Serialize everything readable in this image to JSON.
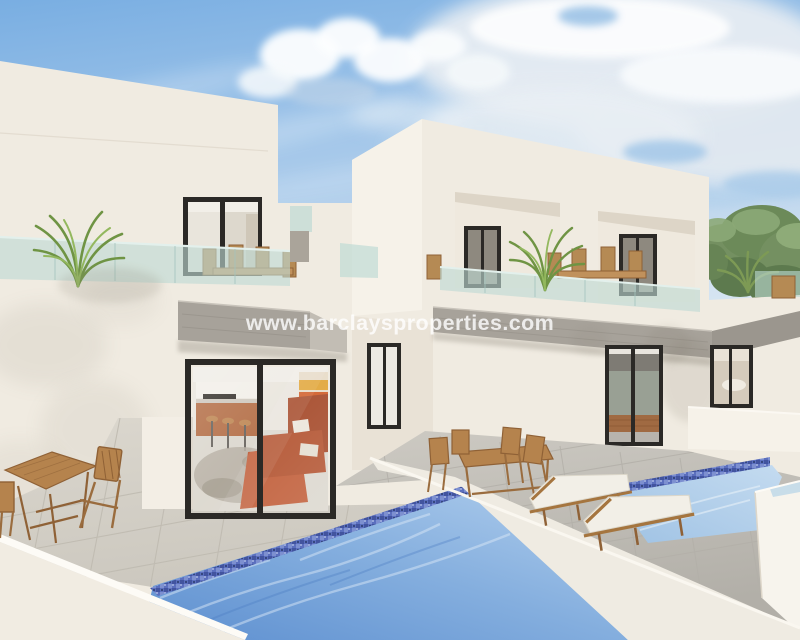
{
  "watermark": {
    "text": "www.barclaysproperties.com"
  },
  "scene": {
    "type": "real-estate-3d-render",
    "subject": "two modern white villas with private pools, roof terraces with glass balustrades, wooden patio furniture and sun loungers"
  },
  "palette": {
    "sky_blue": "#7fb2e2",
    "sky_pale": "#d5e5f2",
    "cloud_white": "#f6f9fc",
    "wall_cream": "#f0ebe1",
    "wall_bright": "#f6f2e9",
    "wall_shadow": "#e4ddd1",
    "concrete_gray": "#a7a29a",
    "glass_teal": "#bedad4",
    "frame_dark": "#2b2926",
    "pool_deep": "#5d8fd0",
    "pool_light": "#b7d4ec",
    "mosaic_blue": "#5b6fbe",
    "waterline_aqua": "#9adde0",
    "tile_warm": "#d7d3ca",
    "tile_gray": "#c5c2bb",
    "wood": "#a97843",
    "sofa_terracotta": "#c2613d",
    "foliage_green": "#6e8f5a"
  }
}
